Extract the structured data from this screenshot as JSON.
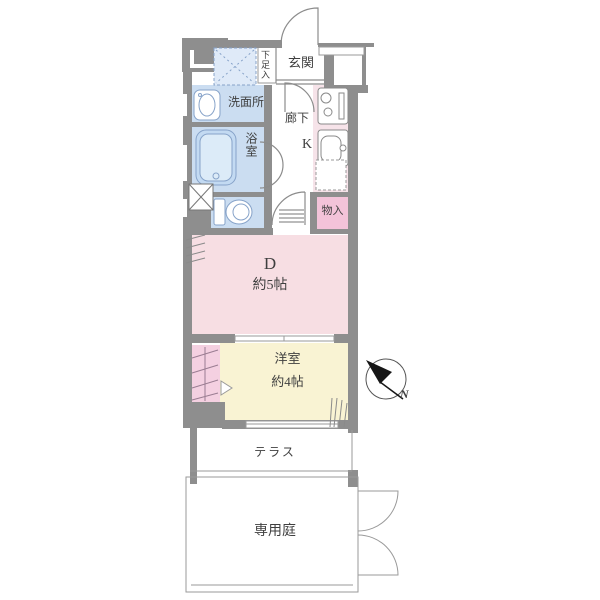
{
  "colors": {
    "wall": "#8e8e8e",
    "outline": "#8f8f8f",
    "thin_line": "#9a9a9a",
    "water_blue": "#cbddf1",
    "tub_blue": "#c3daf2",
    "tub_inner": "#dcebf8",
    "fixture_stroke": "#87a3c9",
    "laundry_blue": "#dfeaf8",
    "dining_pink": "#f7dee3",
    "kitchen_pink": "#f6e3e9",
    "storage_pink": "#f3c3d9",
    "closet_pink": "#f4d0e1",
    "room_yellow": "#f9f3d3",
    "text": "#3f3f3f",
    "compass_black": "#161616"
  },
  "rooms": {
    "genkan": {
      "label": "玄関"
    },
    "shoe_storage": {
      "label": "下足入"
    },
    "washroom": {
      "label": "洗面所"
    },
    "bathroom": {
      "label": "浴室"
    },
    "hallway": {
      "label": "廊下"
    },
    "kitchen": {
      "label": "K"
    },
    "storage": {
      "label": "物入"
    },
    "dining": {
      "label": "D",
      "size": "約5帖"
    },
    "western_room": {
      "label": "洋室",
      "size": "約4帖"
    },
    "terrace": {
      "label": "テラス"
    },
    "garden": {
      "label": "専用庭"
    }
  },
  "compass": {
    "label": "N"
  }
}
